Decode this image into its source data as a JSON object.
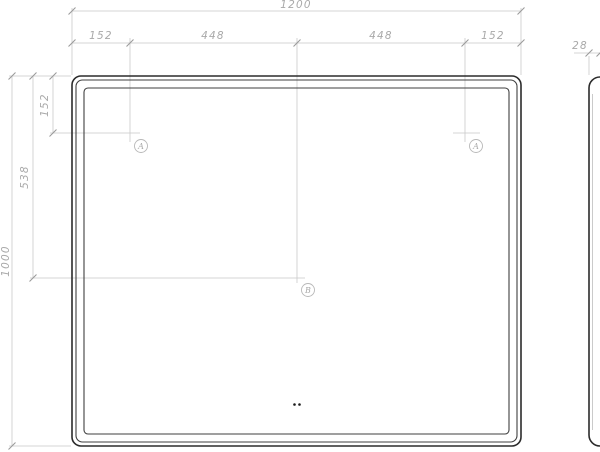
{
  "colors": {
    "drawing_line": "#2b2b2b",
    "secondary_line": "#3f3f3f",
    "dimension_line": "#c9c9c9",
    "tick": "#9a9a9a",
    "dimension_text": "#a9a9a9",
    "callout_stroke": "#b8b8b8",
    "dot": "#1a1a1a"
  },
  "front_view": {
    "overall_width": "1200",
    "overall_height": "1000",
    "top_segments": [
      "152",
      "448",
      "448",
      "152"
    ],
    "side_offsets": {
      "top_to_sensor_row": "152",
      "top_to_center": "538"
    },
    "callouts": {
      "a": "A",
      "b": "B"
    }
  },
  "side_view": {
    "thickness": "28"
  }
}
